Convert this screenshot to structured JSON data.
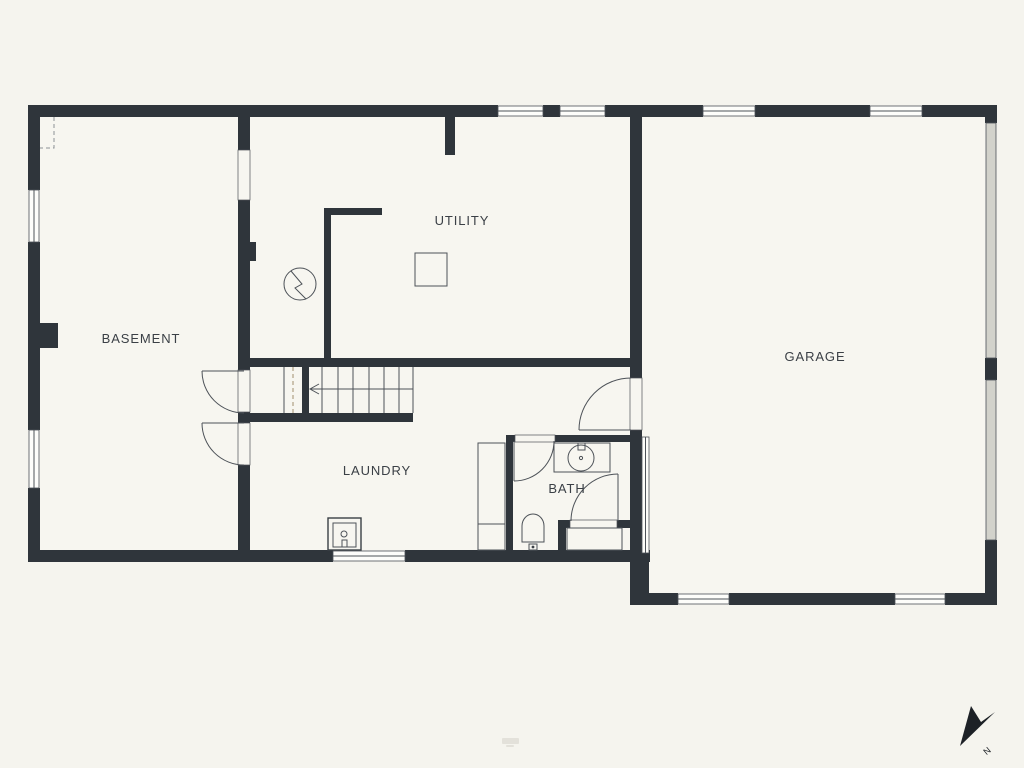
{
  "colors": {
    "bg": "#f5f4ee",
    "floor": "#f7f6f0",
    "wall": "#2f353b",
    "line": "#4d5258",
    "label": "#3b4046",
    "garage_door_fill": "#d2d2cb",
    "accent_dash": "#b0a184",
    "compass": "#1d2126"
  },
  "rooms": {
    "basement": "BASEMENT",
    "utility": "UTILITY",
    "laundry": "LAUNDRY",
    "bath": "BATH",
    "garage": "GARAGE"
  },
  "compass": {
    "north_label": "N"
  },
  "fixtures": [
    "stairs",
    "laundry-sink",
    "bath-sink",
    "toilet",
    "shower",
    "electrical-meter",
    "electrical-panel",
    "counter"
  ]
}
